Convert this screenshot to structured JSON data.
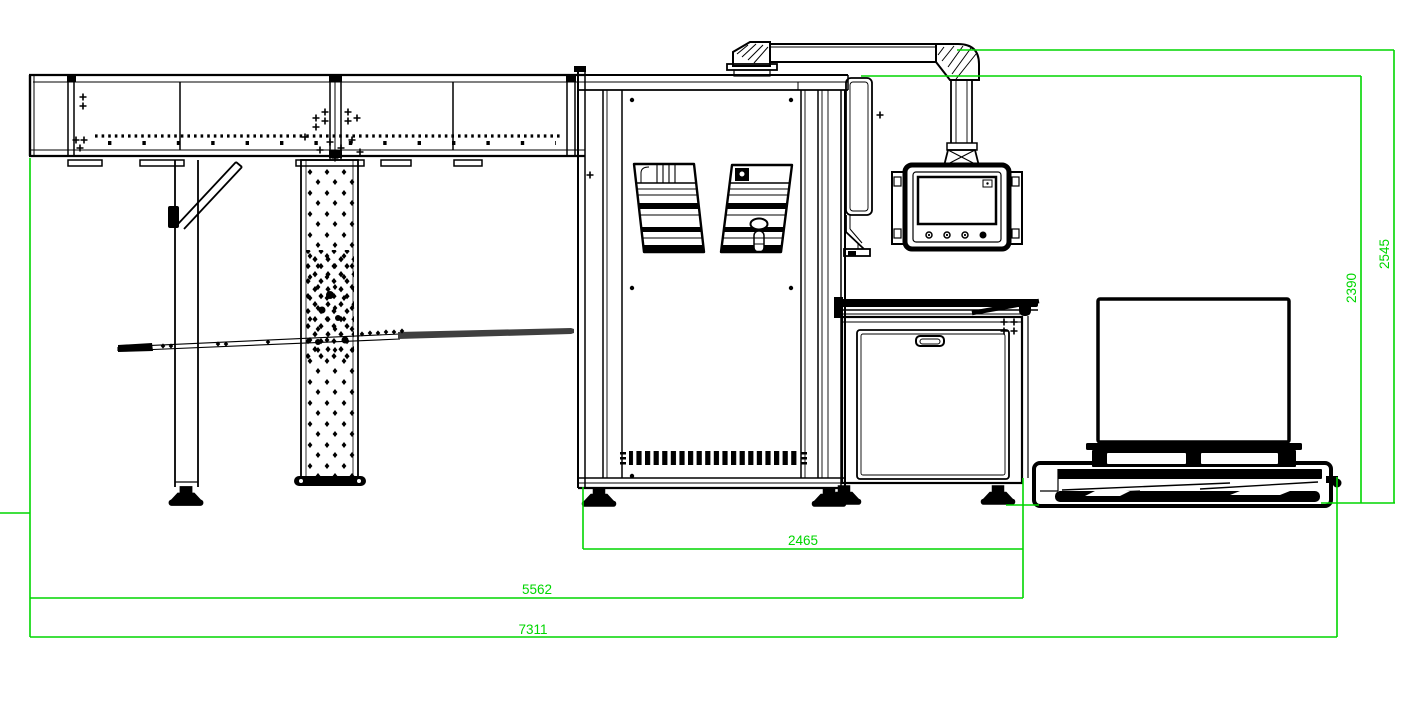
{
  "meta": {
    "title": "Packaging line side elevation drawing"
  },
  "palette": {
    "background": "#ffffff",
    "line_color": "#000000",
    "dimension_color": "#00d600",
    "steel_gray": "#3f3f3f"
  },
  "dimensions": {
    "machine_width_mm": "2465",
    "span_width_mm": "5562",
    "overall_length_mm": "7311",
    "machine_height_mm": "2390",
    "overall_height_mm": "2545"
  },
  "components": [
    "infeed-conveyor",
    "conveyor-leg",
    "diagonal-brace",
    "perforated-column",
    "guide-blade",
    "main-machine-cabinet",
    "cabinet-window-left",
    "cabinet-window-right",
    "ventilation-grille",
    "side-panel",
    "cable-duct",
    "hmi-monitor",
    "lower-cabinet",
    "roller-conveyor",
    "carton-box",
    "pallet",
    "pallet-platform"
  ]
}
